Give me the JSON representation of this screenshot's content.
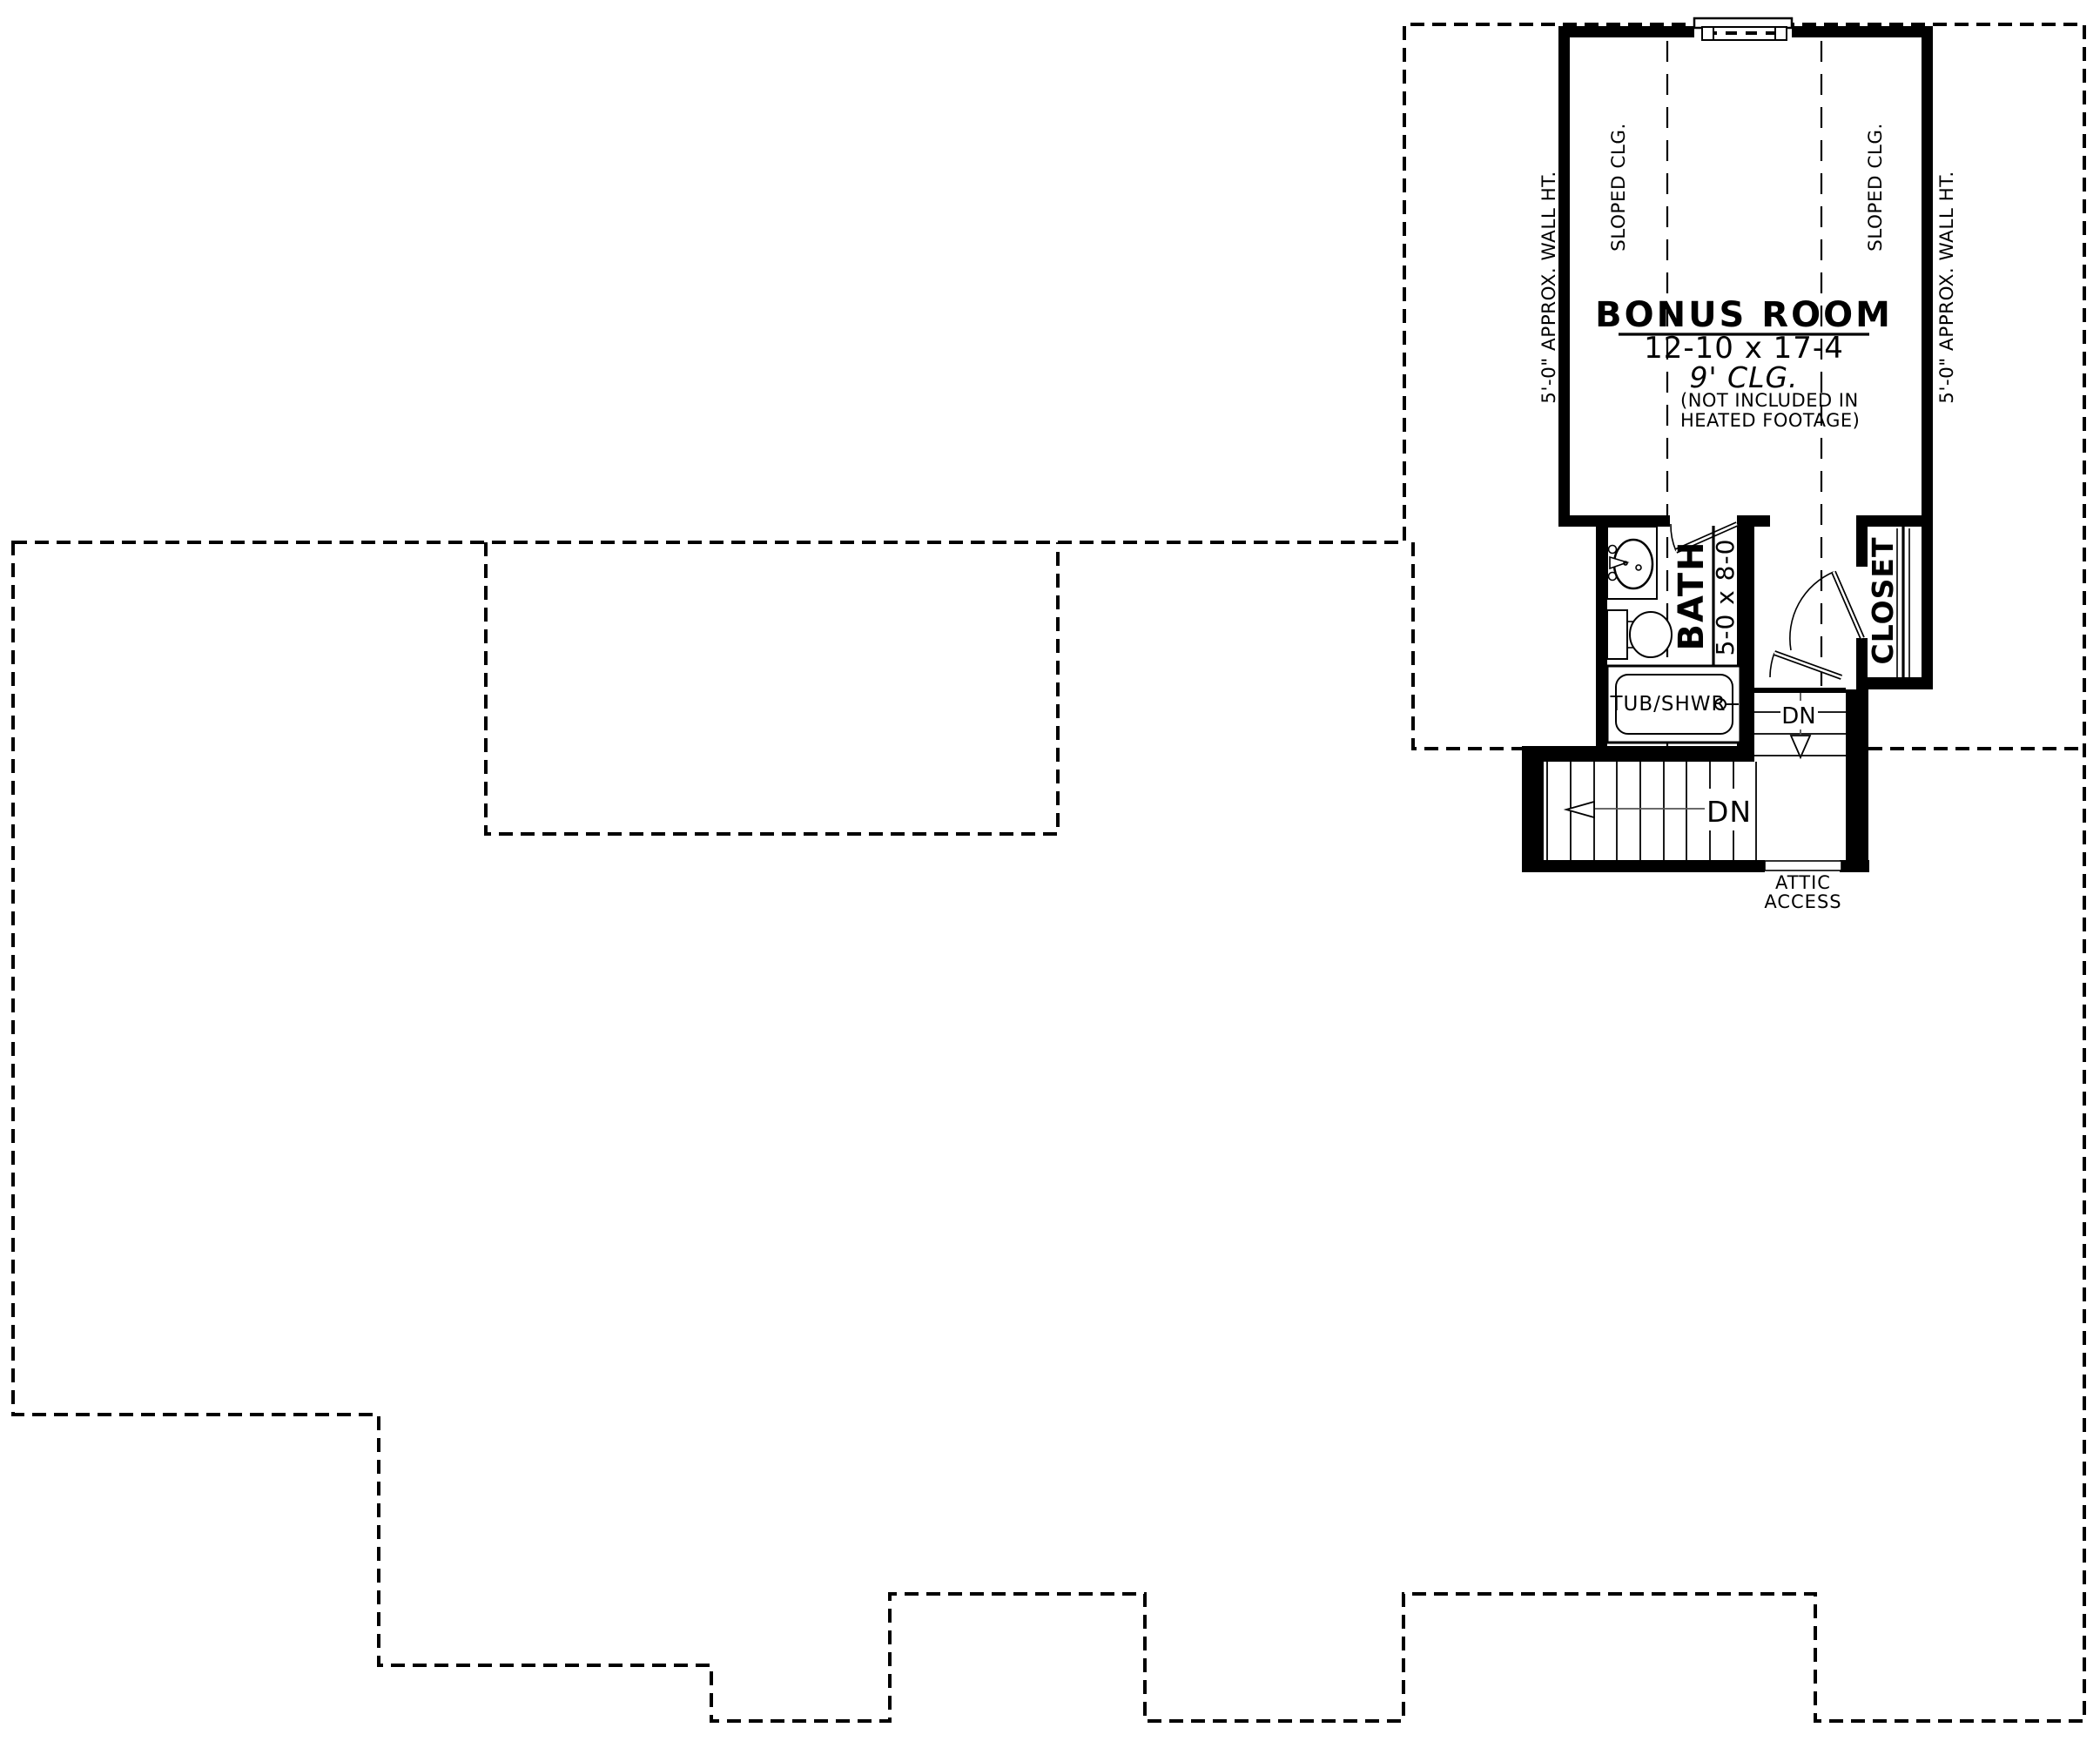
{
  "document": {
    "type": "floor-plan",
    "background_color": "#ffffff",
    "ink_color": "#000000"
  },
  "bonus_room": {
    "title": "BONUS ROOM",
    "dimensions": "12-10 x 17-4",
    "ceiling_height": "9' CLG.",
    "note_line1": "(NOT INCLUDED IN",
    "note_line2": "HEATED FOOTAGE)",
    "sloped_ceiling_left": "SLOPED CLG.",
    "sloped_ceiling_right": "SLOPED CLG.",
    "wall_height_left": "5'-0\" APPROX. WALL HT.",
    "wall_height_right": "5'-0\" APPROX. WALL HT."
  },
  "bathroom": {
    "title": "BATH",
    "dimensions": "5-0 x 8-0",
    "tub_label": "TUB/SHWR"
  },
  "closet": {
    "title": "CLOSET"
  },
  "stairs": {
    "down_label_main": "DN",
    "down_label_upper": "DN",
    "attic_access_line1": "ATTIC",
    "attic_access_line2": "ACCESS"
  }
}
